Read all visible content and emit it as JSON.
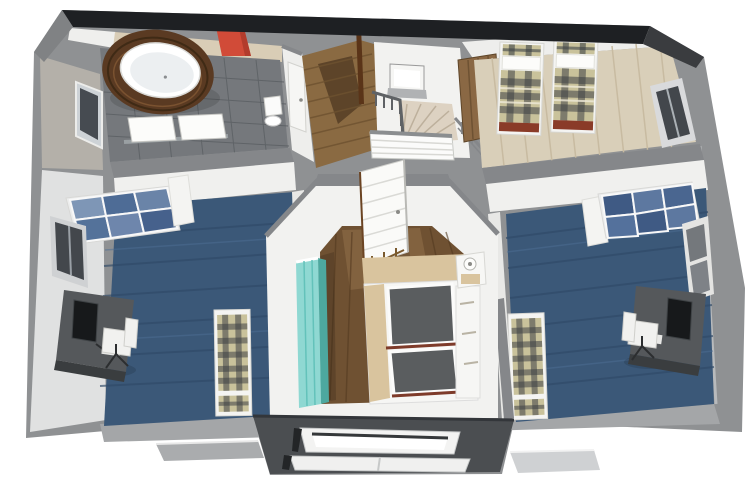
{
  "meta": {
    "title": "3D dollhouse floor plan — upper storey cutaway view",
    "view": "isometric-top-down",
    "visible_text": ""
  },
  "palette": {
    "background": "#ffffff",
    "exterior_wall": "#8f9193",
    "roof_edge_dark": "#1e2023",
    "wall_top_gray": "#85878a",
    "wall_face_white": "#f2f2f0",
    "bottom_band": "#a4a6a8",
    "carpet_blue": "#3b5878",
    "wood_light": "#d9cfb9",
    "wood_medium": "#8a6a42",
    "wood_dark": "#6f5132",
    "tile_granite": "#75787c",
    "wood_bath_strip": "#d9cdb6",
    "tub_wood": "#5a3a22",
    "towel_red": "#d14b38",
    "bed_red_brown": "#8a3b28",
    "plaid_khaki": "#c9c29b",
    "plaid_dark": "#3e4246",
    "wardrobe_aqua": "#8fd8d2",
    "glass_blue": "#6e86ac",
    "desk_gray": "#55585b",
    "monitor_black": "#17191b",
    "stair_beige": "#ddd2c2",
    "mattress_gray": "#5a5d5f",
    "bed_beige": "#d9c49e",
    "bay_gray": "#4b4e51",
    "window_dark": "#43474c"
  },
  "scene": {
    "rooms": [
      {
        "name": "bathroom",
        "position": "top-left",
        "floor": "granite-tile",
        "furniture": [
          "oval-bathtub-in-wood-surround",
          "red-towel-on-rail",
          "double-sink-vanity",
          "wall-mirror",
          "toilet"
        ]
      },
      {
        "name": "hallway-landing",
        "position": "top-center",
        "floor": "wood-medium",
        "furniture": [
          "curved-staircase",
          "stair-railing",
          "white-balustrade",
          "bathroom-door"
        ]
      },
      {
        "name": "twin-bedroom",
        "position": "top-right",
        "floor": "wood-light",
        "furniture": [
          "twin-bed-left",
          "twin-bed-right",
          "open-wood-door",
          "wall-window"
        ]
      },
      {
        "name": "study-left",
        "position": "middle-left",
        "floor": "carpet-blue",
        "furniture": [
          "glass-display-cabinet",
          "desk-with-monitor",
          "desk-chair",
          "single-bed-plaid",
          "wall-window"
        ]
      },
      {
        "name": "study-right",
        "position": "middle-right",
        "floor": "carpet-blue",
        "furniture": [
          "glass-display-cabinet",
          "desk-with-monitor",
          "desk-chair",
          "single-bed-plaid",
          "wall-window"
        ]
      },
      {
        "name": "master-bedroom",
        "position": "bottom-center",
        "floor": "wood-dark",
        "furniture": [
          "double-bed-gray-mattresses",
          "nightstand-with-lamp",
          "aqua-wardrobe",
          "open-white-door"
        ]
      }
    ],
    "exterior": [
      "cutaway-gray-walls",
      "dark-roof-edge",
      "bay-window-bottom",
      "window-sill-left",
      "window-sill-right"
    ]
  }
}
